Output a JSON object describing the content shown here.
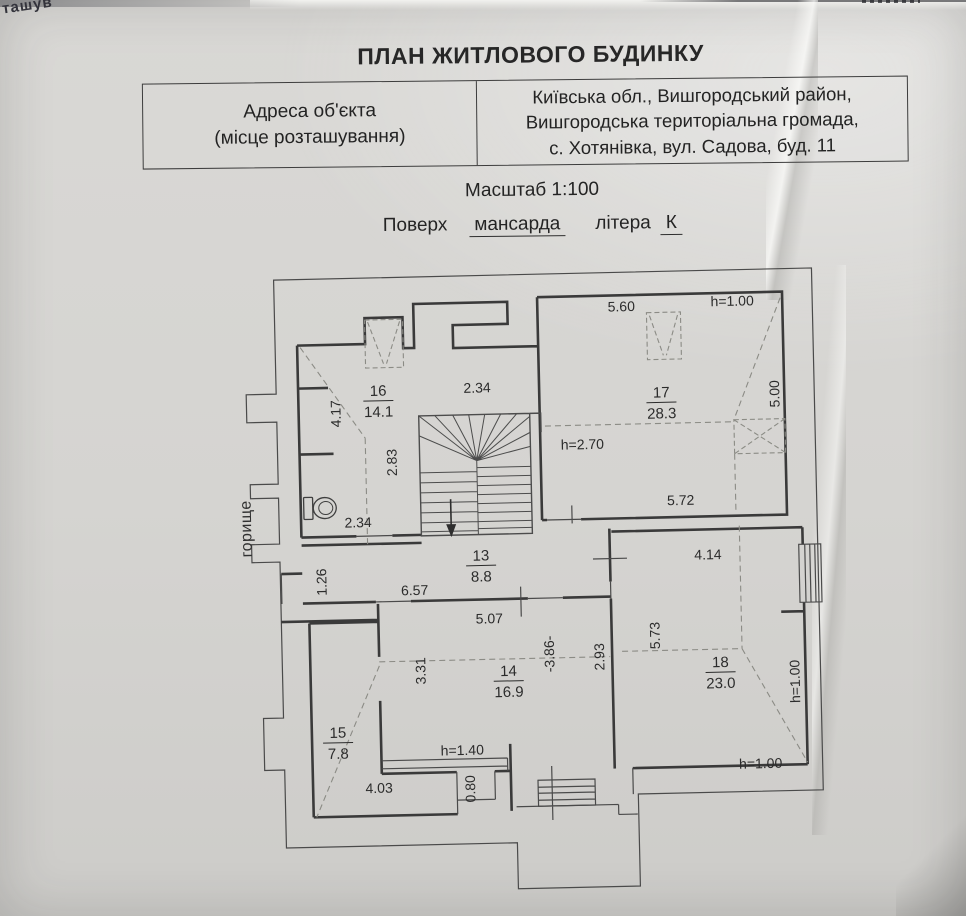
{
  "page": {
    "corner_fragment": "ташув",
    "title": "ПЛАН ЖИТЛОВОГО БУДИНКУ",
    "address_table": {
      "label": [
        "Адреса об'єкта",
        "(місце розташування)"
      ],
      "value": [
        "Київська обл., Вишгородський район,",
        "Вишгородська територіальна громада,",
        "с. Хотянівка, вул. Садова, буд. 11"
      ]
    },
    "scale_line": "Масштаб 1:100",
    "floor_line": {
      "prefix": "Поверх",
      "floor": "мансарда",
      "letter_label": "літера",
      "letter": "К"
    }
  },
  "plan": {
    "attic_label": {
      "text": "горище",
      "x": 252,
      "y": 522,
      "rotate": -90
    },
    "rooms": [
      {
        "number": "16",
        "area": "14.1",
        "x": 382,
        "y": 392
      },
      {
        "number": "17",
        "area": "28.3",
        "x": 665,
        "y": 400
      },
      {
        "number": "13",
        "area": "8.8",
        "x": 481,
        "y": 559
      },
      {
        "number": "14",
        "area": "16.9",
        "x": 506,
        "y": 675
      },
      {
        "number": "15",
        "area": "7.8",
        "x": 334,
        "y": 733
      },
      {
        "number": "18",
        "area": "23.0",
        "x": 718,
        "y": 671
      }
    ],
    "dimensions": [
      {
        "text": "4.17",
        "x": 344,
        "y": 409,
        "rotate": -90
      },
      {
        "text": "2.34",
        "x": 481,
        "y": 391,
        "rotate": 0
      },
      {
        "text": "2.83",
        "x": 399,
        "y": 459,
        "rotate": -90
      },
      {
        "text": "2.34",
        "x": 359,
        "y": 523,
        "rotate": 0
      },
      {
        "text": "5.60",
        "x": 627,
        "y": 313,
        "rotate": 0
      },
      {
        "text": "h=1.00",
        "x": 738,
        "y": 310,
        "rotate": 0
      },
      {
        "text": "5.00",
        "x": 783,
        "y": 399,
        "rotate": -90
      },
      {
        "text": "h=2.70",
        "x": 585,
        "y": 450,
        "rotate": 0
      },
      {
        "text": "5.72",
        "x": 682,
        "y": 508,
        "rotate": 0
      },
      {
        "text": "1.26",
        "x": 326,
        "y": 577,
        "rotate": -90
      },
      {
        "text": "6.57",
        "x": 414,
        "y": 592,
        "rotate": 0
      },
      {
        "text": "4.14",
        "x": 708,
        "y": 563,
        "rotate": 0
      },
      {
        "text": "5.73",
        "x": 658,
        "y": 638,
        "rotate": -90
      },
      {
        "text": "h=1.00",
        "x": 797,
        "y": 687,
        "rotate": -90
      },
      {
        "text": "h=1.00",
        "x": 756,
        "y": 773,
        "rotate": 0
      },
      {
        "text": "5.07",
        "x": 488,
        "y": 622,
        "rotate": 0
      },
      {
        "text": "3.31",
        "x": 423,
        "y": 668,
        "rotate": -90
      },
      {
        "text": "-3.86-",
        "x": 552,
        "y": 654,
        "rotate": -90
      },
      {
        "text": "2.93",
        "x": 602,
        "y": 658,
        "rotate": -90
      },
      {
        "text": "h=1.40",
        "x": 458,
        "y": 753,
        "rotate": 0
      },
      {
        "text": "4.03",
        "x": 374,
        "y": 789,
        "rotate": 0
      },
      {
        "text": "0.80",
        "x": 470,
        "y": 787,
        "rotate": -90
      }
    ]
  }
}
